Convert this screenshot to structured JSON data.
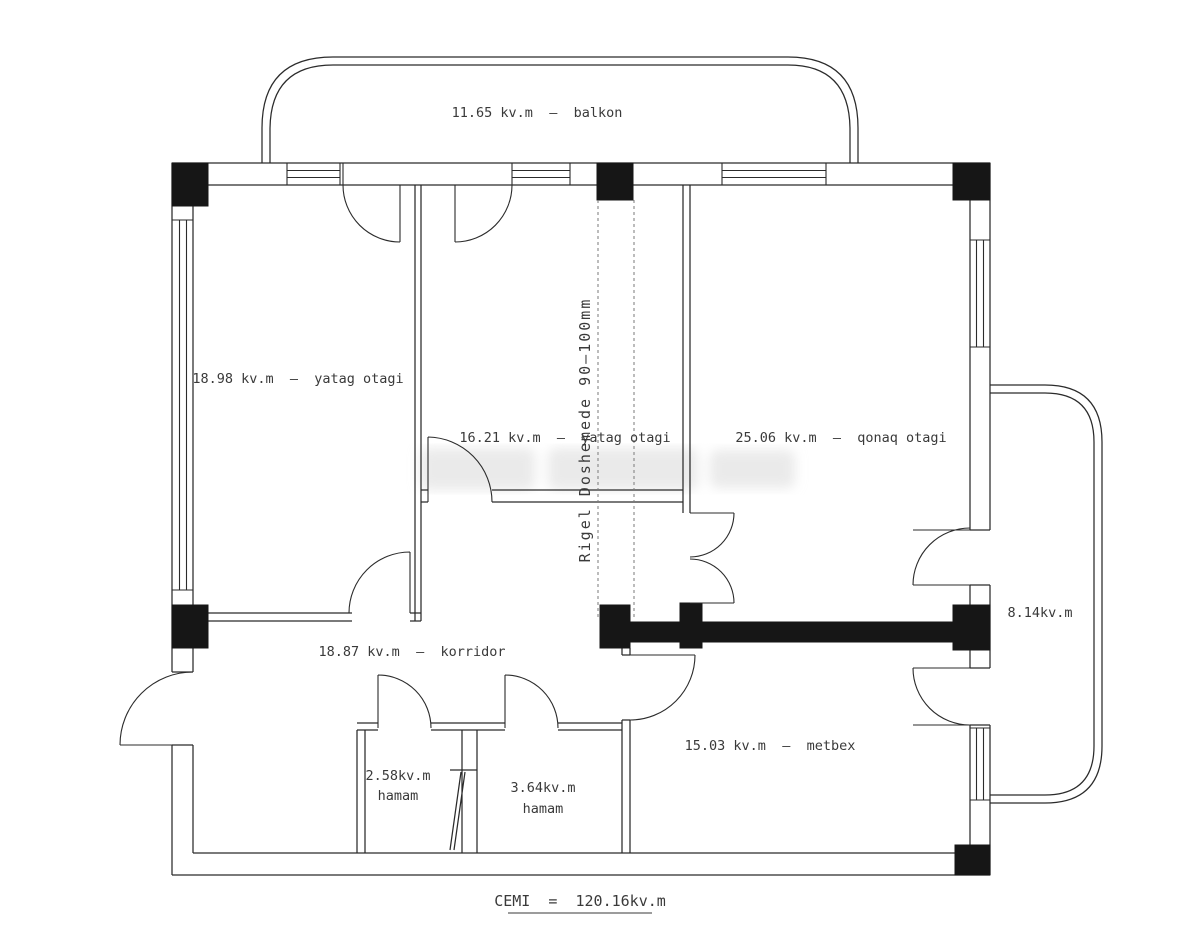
{
  "labels": {
    "balcony_top": "11.65 kv.m  –  balkon",
    "bedroom_left": "18.98 kv.m  –  yatag otagi",
    "bedroom_middle": "16.21 kv.m  –  yatag otagi",
    "living_room": "25.06 kv.m  –  qonaq otagi",
    "corridor": "18.87 kv.m  –  korridor",
    "bath_small_area": "2.58kv.m",
    "bath_small_name": "hamam",
    "bath_large_area": "3.64kv.m",
    "bath_large_name": "hamam",
    "kitchen": "15.03 kv.m  –  metbex",
    "balcony_right": "8.14kv.m",
    "beam_note": "Rigel Doshemede 90–100mm",
    "total": "CEMI  =  120.16kv.m"
  },
  "colors": {
    "line": "#2b2b2b",
    "structural_fill": "#161616",
    "beam_dash": "#7a7a7a",
    "background": "#ffffff",
    "text": "#3a3a3a"
  }
}
